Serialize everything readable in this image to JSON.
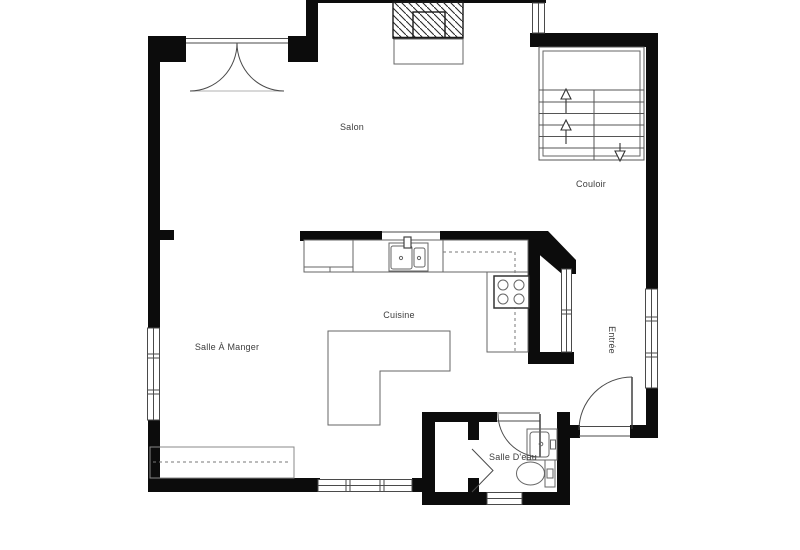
{
  "floorplan": {
    "rooms": {
      "salon": "Salon",
      "couloir": "Couloir",
      "cuisine": "Cuisine",
      "salle_a_manger": "Salle À Manger",
      "entree": "Entrée",
      "salle_deau": "Salle D'eau"
    },
    "fixtures": [
      "fireplace",
      "hearth",
      "staircase",
      "french-doors",
      "kitchen-sink",
      "stove",
      "kitchen-island",
      "buffet-cabinet",
      "vanity-sink",
      "toilet",
      "bifold-closet-door",
      "entry-door",
      "bathroom-door"
    ],
    "colors": {
      "wall": "#0c0c0c",
      "line": "#555555",
      "background": "#ffffff"
    }
  }
}
